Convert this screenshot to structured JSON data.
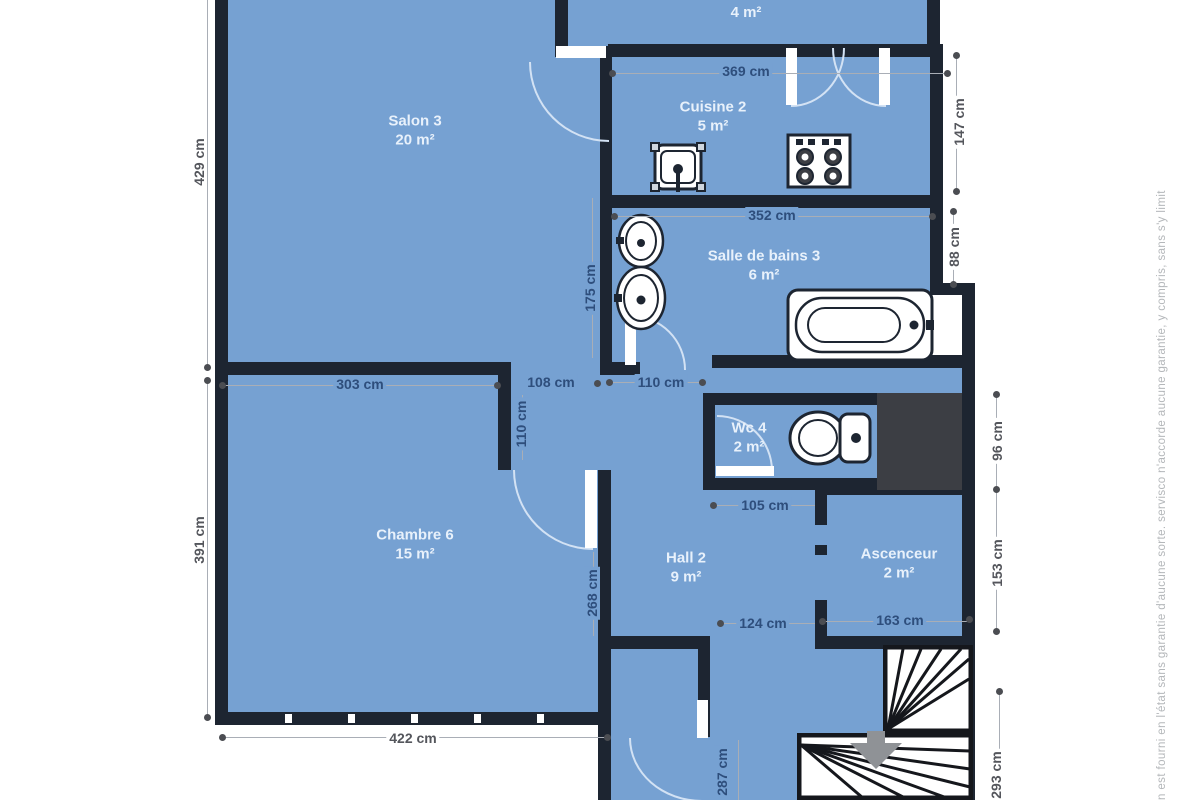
{
  "colors": {
    "room_fill": "#76a1d2",
    "wall": "#1d2531",
    "shaft": "#3c3e44",
    "dim_text_on_blue": "#2e4e7c",
    "dim_text_on_white": "#54565c",
    "room_label_text": "#e8f1fb",
    "door_arc": "#d3e2f4",
    "stair_line": "#15171c",
    "arrow_gray": "#8f9296"
  },
  "rooms": [
    {
      "id": "salon-top",
      "name": "Salon",
      "area": "4 m²"
    },
    {
      "id": "salon-3",
      "name": "Salon 3",
      "area": "20 m²"
    },
    {
      "id": "cuisine-2",
      "name": "Cuisine 2",
      "area": "5 m²"
    },
    {
      "id": "salle-de-bains-3",
      "name": "Salle de bains 3",
      "area": "6 m²"
    },
    {
      "id": "chambre-6",
      "name": "Chambre 6",
      "area": "15 m²"
    },
    {
      "id": "wc-4",
      "name": "Wc 4",
      "area": "2 m²"
    },
    {
      "id": "hall-2",
      "name": "Hall 2",
      "area": "9 m²"
    },
    {
      "id": "ascenceur",
      "name": "Ascenceur",
      "area": "2 m²"
    }
  ],
  "dims": {
    "d429": "429 cm",
    "d391": "391 cm",
    "d422": "422 cm",
    "d369": "369 cm",
    "d147": "147 cm",
    "d352": "352 cm",
    "d88": "88 cm",
    "d175": "175 cm",
    "d303": "303 cm",
    "d108": "108 cm",
    "d110h": "110 cm",
    "d110v": "110 cm",
    "d96": "96 cm",
    "d153": "153 cm",
    "d105": "105 cm",
    "d124": "124 cm",
    "d163": "163 cm",
    "d268": "268 cm",
    "d287": "287 cm",
    "d293": "293 cm"
  },
  "icons": [
    "kitchen-sink-icon",
    "stove-icon",
    "washbasin-icon",
    "washbasin-icon",
    "bathtub-icon",
    "toilet-icon",
    "stairs-upper-icon",
    "stairs-lower-icon",
    "stairs-down-arrow-icon"
  ],
  "disclaimer": "n est fourni en l'état sans garantie d'aucune sorte. servisco n'accorde aucune garantie, y compris, sans s'y limit"
}
